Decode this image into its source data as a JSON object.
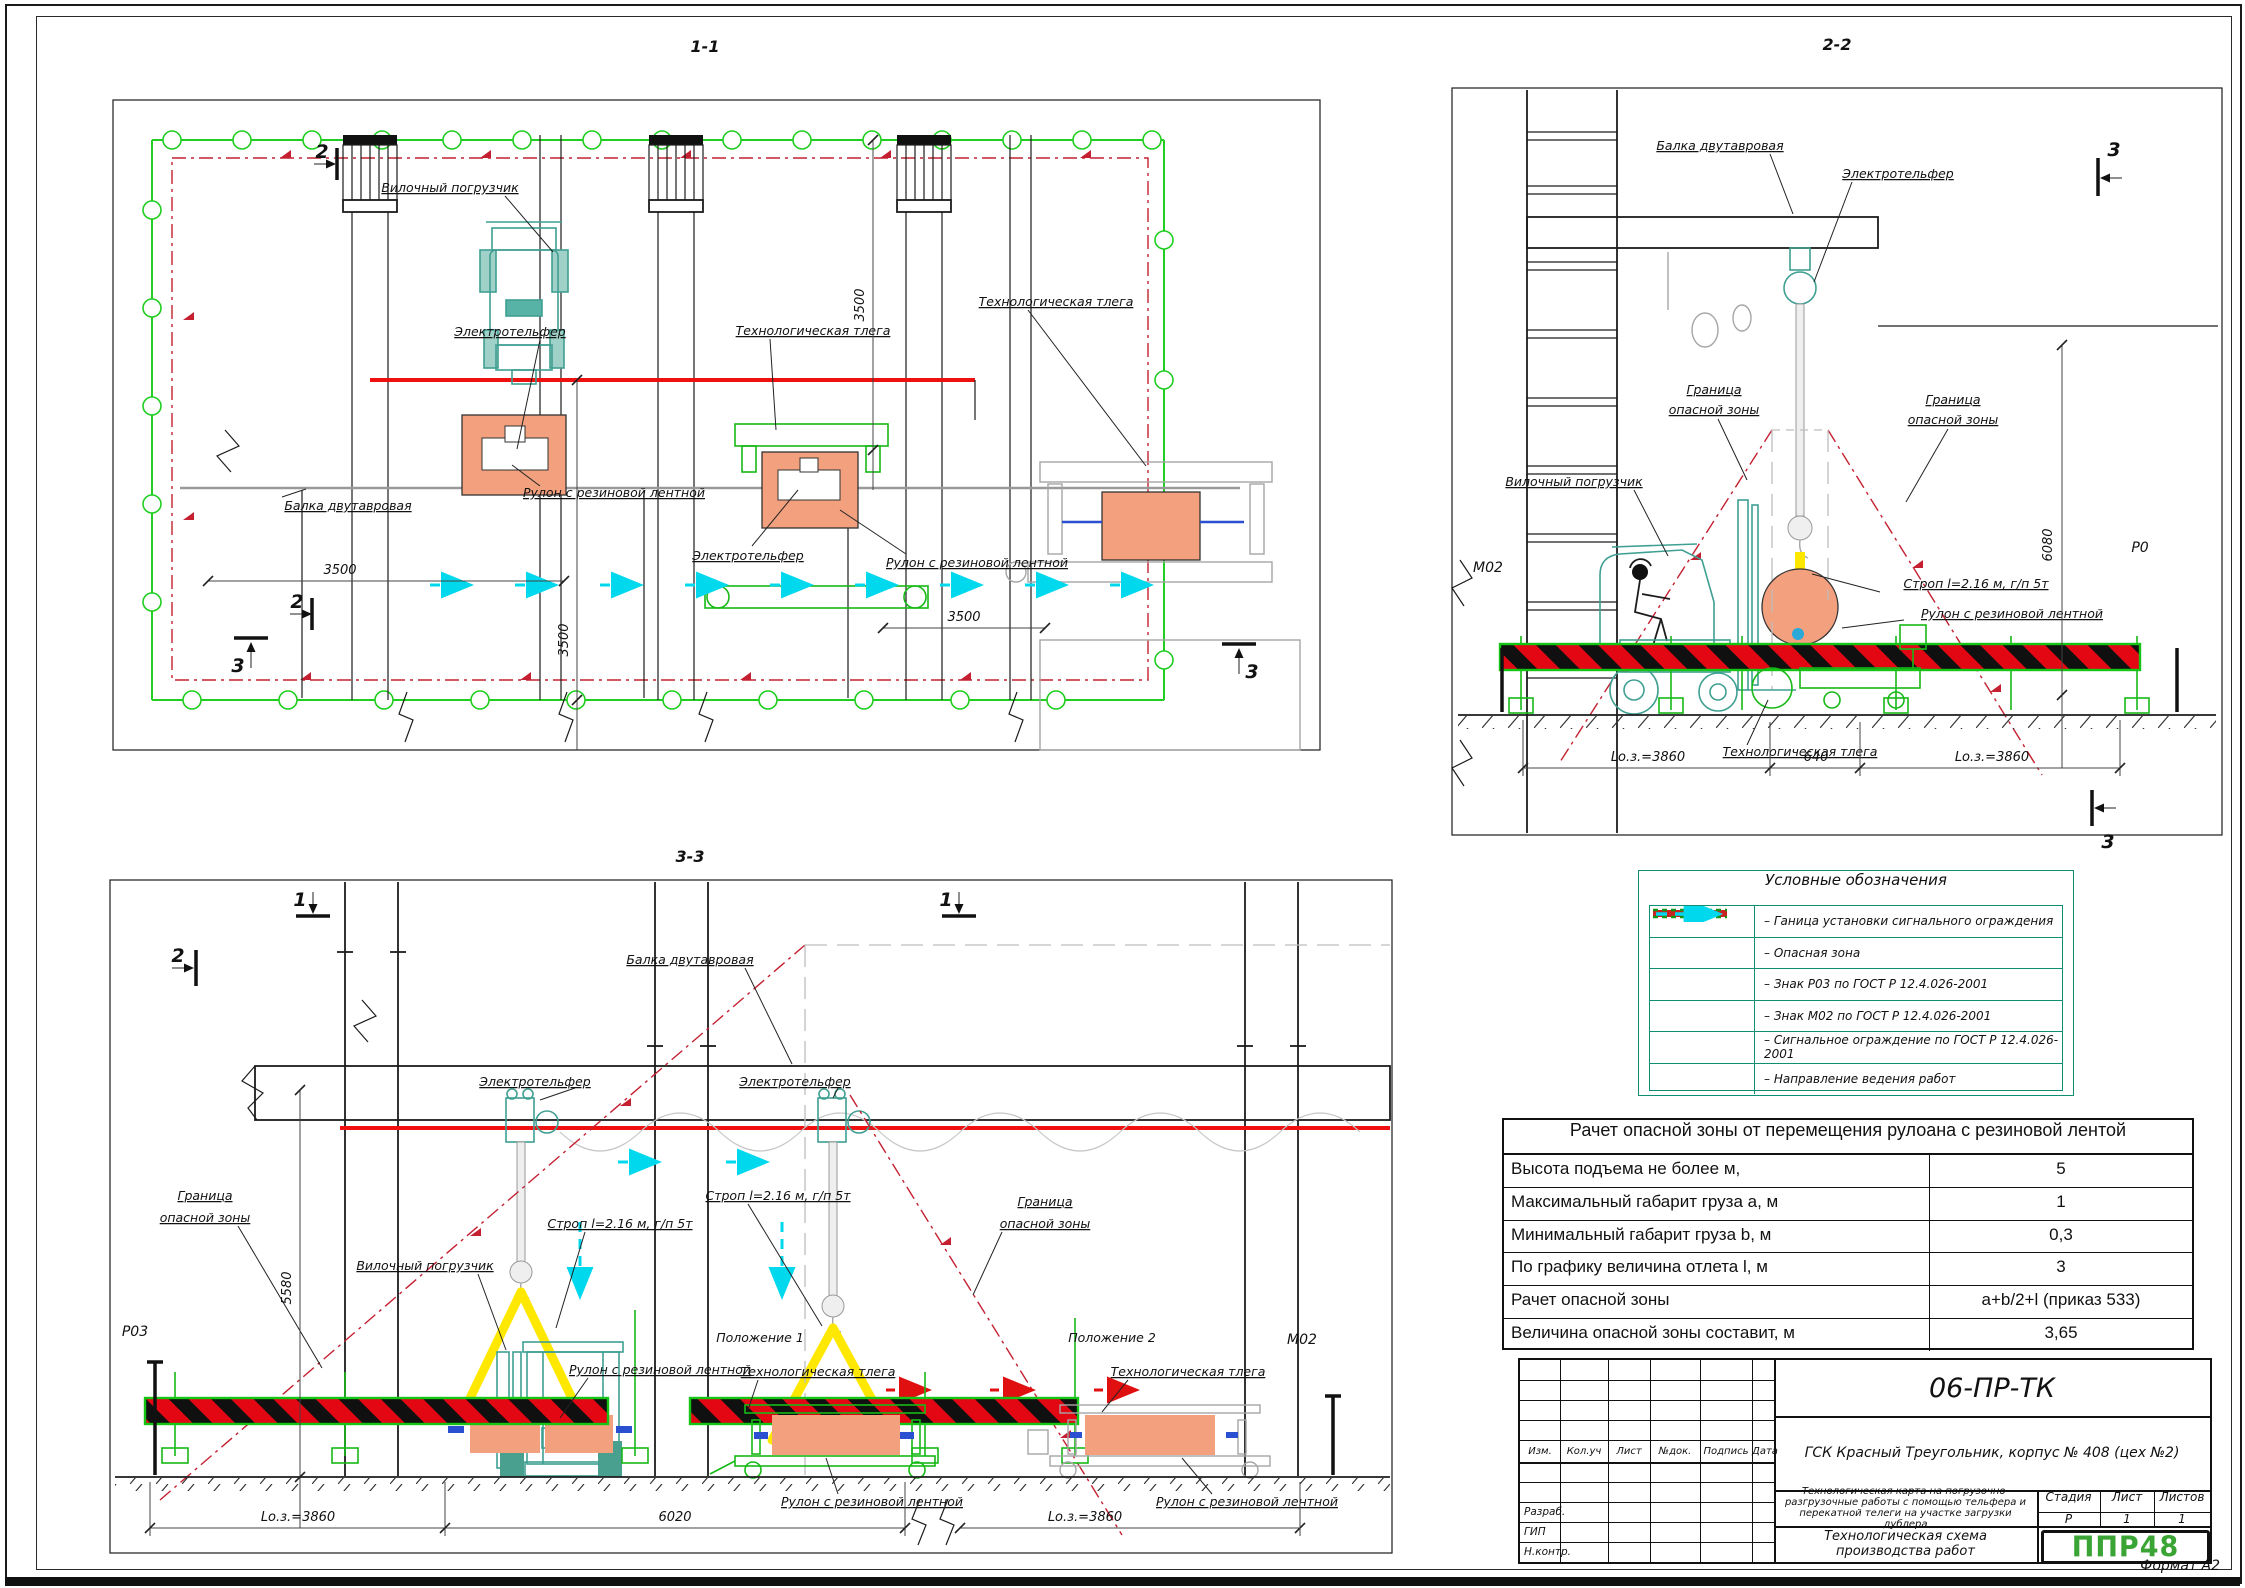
{
  "sheet": {
    "format": "Формат А2"
  },
  "colors": {
    "fence_green": "#21ce21",
    "danger_red": "#c42031",
    "opasnaya_red": "#ef1010",
    "signal_cyan": "#00d8ee",
    "sling_yellow": "#ffe800",
    "load_salmon": "#f2a07e",
    "equipment_teal": "#3f9f92",
    "logo_green": "#3aa535",
    "legend_border_teal": "#0e8f73"
  },
  "terms": {
    "forklift": "Вилочный погрузчик",
    "hoist": "Электротельфер",
    "trolley": "Технологическая тлега",
    "beam": "Балка двутавровая",
    "roll": "Рулон с резиновой лентной",
    "sling": "Строп l=2.16 м, г/п 5т",
    "boundary_l1": "Граница",
    "boundary_l2": "опасной зоны",
    "pos1": "Положение 1",
    "pos2": "Положение 2",
    "sign_m02": "М02",
    "sign_p03": "Р03",
    "sign_p0": "Р0"
  },
  "views": {
    "v11": {
      "title": "1-1",
      "dims": [
        "3500",
        "3500",
        "3500",
        "3500"
      ],
      "marker2": "2",
      "marker3": "3"
    },
    "v22": {
      "title": "2-2",
      "dims": {
        "h": "6080",
        "l1": "Lо.з.=3860",
        "m": "640",
        "l2": "Lо.з.=3860"
      },
      "marker3": "3"
    },
    "v33": {
      "title": "3-3",
      "dims": {
        "h": "5580",
        "l1": "Lо.з.=3860",
        "m": "6020",
        "l2": "Lо.з.=3860"
      },
      "marker1": "1",
      "marker2": "2"
    }
  },
  "legend": {
    "title": "Условные обозначения",
    "items": [
      {
        "symbol": "green-line-icon",
        "label": "– Ганица установки сигнального ограждения"
      },
      {
        "symbol": "red-line-icon",
        "label": "– Опасная зона"
      },
      {
        "symbol": "blank",
        "label": "– Знак Р03 по ГОСТ Р 12.4.026-2001"
      },
      {
        "symbol": "blank",
        "label": "– Знак М02 по ГОСТ Р 12.4.026-2001"
      },
      {
        "symbol": "signal-fence-icon",
        "label": "– Сигнальное ограждение по ГОСТ Р 12.4.026-2001"
      },
      {
        "symbol": "cyan-arrow-icon",
        "label": "– Направление ведения работ"
      }
    ]
  },
  "calc_table": {
    "title": "Рачет опасной зоны от перемещения рулоана с резиновой лентой",
    "rows": [
      {
        "label": "Высота подъема не более м,",
        "value": "5"
      },
      {
        "label": "Максимальный габарит груза a, м",
        "value": "1"
      },
      {
        "label": "Минимальный габарит груза b, м",
        "value": "0,3"
      },
      {
        "label": "По графику величина отлета l, м",
        "value": "3"
      },
      {
        "label": "Рачет опасной зоны",
        "value": "a+b/2+l (приказ 533)"
      },
      {
        "label": "Величина опасной зоны составит, м",
        "value": "3,65"
      }
    ]
  },
  "title_block": {
    "doc_number": "06-ПР-ТК",
    "object": "ГСК Красный Треугольник, корпус № 408 (цех №2)",
    "rev_headers": [
      "Изм.",
      "Кол.уч",
      "Лист",
      "№док.",
      "Подпись",
      "Дата"
    ],
    "description": "Технологическая карта на погрузочно-разгрузочные работы с помощью тельфера и перекатной телеги на участке загрузки дублера",
    "stage_header": "Стадия",
    "sheet_header": "Лист",
    "sheets_header": "Листов",
    "stage": "Р",
    "sheet": "1",
    "sheets": "1",
    "roles": [
      "Разраб.",
      "ГИП",
      "Н.контр."
    ],
    "scheme_title": "Технологическая схема производства работ",
    "logo": "ППР48"
  }
}
